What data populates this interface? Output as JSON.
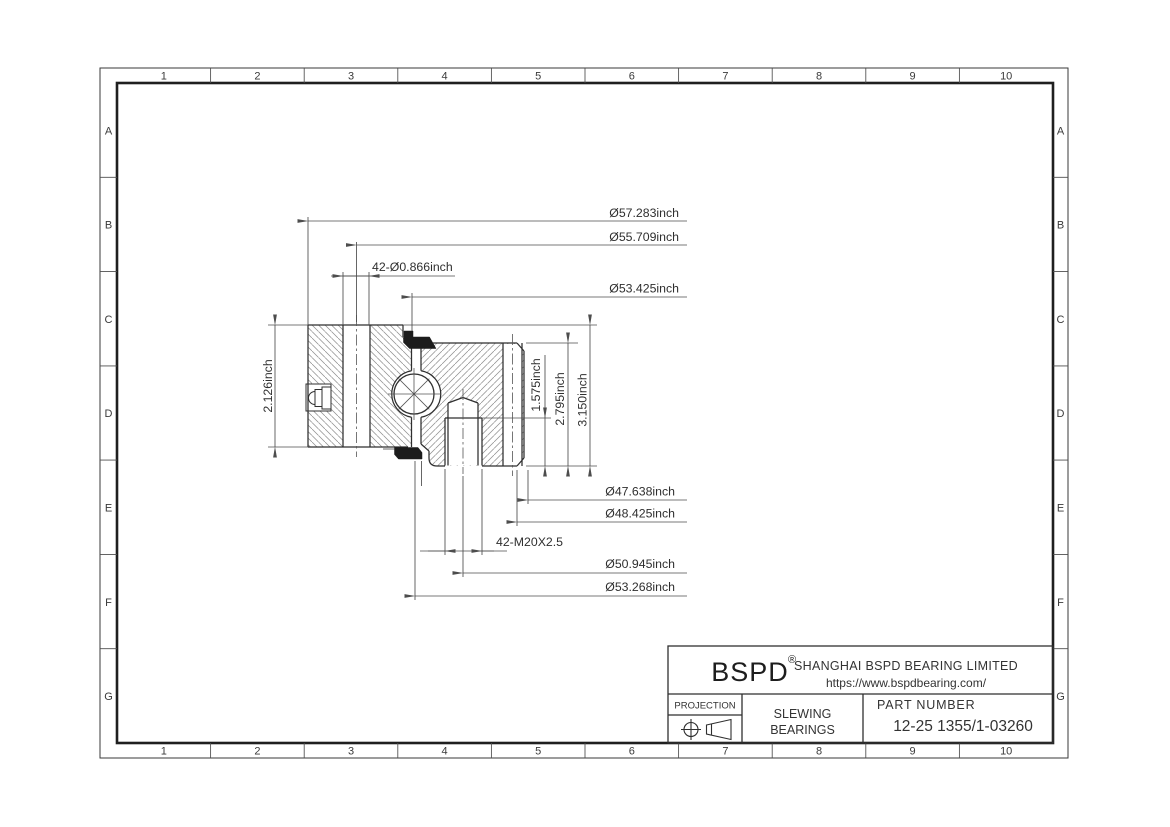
{
  "grid": {
    "cols": [
      "1",
      "2",
      "3",
      "4",
      "5",
      "6",
      "7",
      "8",
      "9",
      "10"
    ],
    "rows": [
      "A",
      "B",
      "C",
      "D",
      "E",
      "F",
      "G"
    ]
  },
  "dims": {
    "outer_diameter": "Ø57.283inch",
    "inner_bolt_circle": "Ø55.709inch",
    "inner_mount_holes": "42-Ø0.866inch",
    "upper_raceway": "Ø53.425inch",
    "inner_ring_height": "2.126inch",
    "thread_depth": "1.575inch",
    "outer_ring_height": "2.795inch",
    "overall_height": "3.150inch",
    "bore_diameter": "Ø47.638inch",
    "outer_ring_bore": "Ø48.425inch",
    "outer_mount_holes": "42-M20X2.5",
    "outer_bolt_circle": "Ø50.945inch",
    "lower_raceway": "Ø53.268inch"
  },
  "title_block": {
    "logo": "BSPD",
    "registered_mark": "®",
    "company": "SHANGHAI BSPD BEARING LIMITED",
    "website": "https://www.bspdbearing.com/",
    "projection_label": "PROJECTION",
    "product_line1": "SLEWING",
    "product_line2": "BEARINGS",
    "part_number_label": "PART  NUMBER",
    "part_number": "12-25 1355/1-03260"
  }
}
